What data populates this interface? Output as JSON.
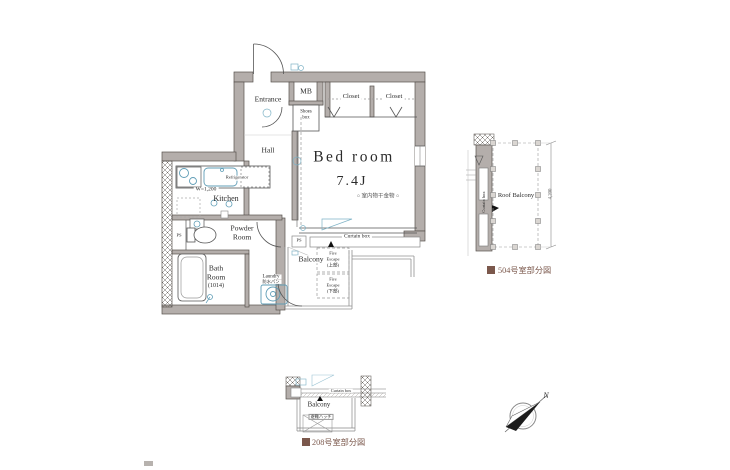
{
  "plan": {
    "labels": {
      "entrance": "Entrance",
      "mb": "MB",
      "closet_left": "Closet",
      "closet_right": "Closet",
      "shoes_line1": "Shoes",
      "shoes_line2": "box",
      "hall": "Hall",
      "bedroom_name": "Bed room",
      "bedroom_size": "7.4J",
      "bedroom_note": "○ 室内物干金物 ○",
      "kitchen": "Kitchen",
      "kitchen_width": "W=1,200",
      "refrigerator": "Refrigerator",
      "powder_line1": "Powder",
      "powder_line2": "Room",
      "bath_line1": "Bath",
      "bath_line2": "Room",
      "bath_line3": "(1014)",
      "laundry": "Laundry",
      "laundry_sub": "防水パン",
      "ps": "PS",
      "balcony": "Balcony",
      "curtain_box": "Curtain box",
      "fire_escape_upper": [
        "Fire",
        "Escape",
        "(上部)"
      ],
      "fire_escape_lower": [
        "Fire",
        "Escape",
        "(下部)"
      ]
    }
  },
  "detail_504": {
    "roof_balcony": "Roof Balcony",
    "curtain_box": "Curtain box",
    "dimension": "4,200",
    "caption": "504号室部分図"
  },
  "detail_208": {
    "curtain_box": "Curtain box",
    "balcony": "Balcony",
    "hatch_label": "避難ハッチ",
    "caption": "208号室部分図"
  },
  "compass": {
    "north": "N"
  },
  "colors": {
    "wall": "#b4aeab",
    "fixture_accent": "#5f9db6",
    "caption": "#7b584c"
  }
}
